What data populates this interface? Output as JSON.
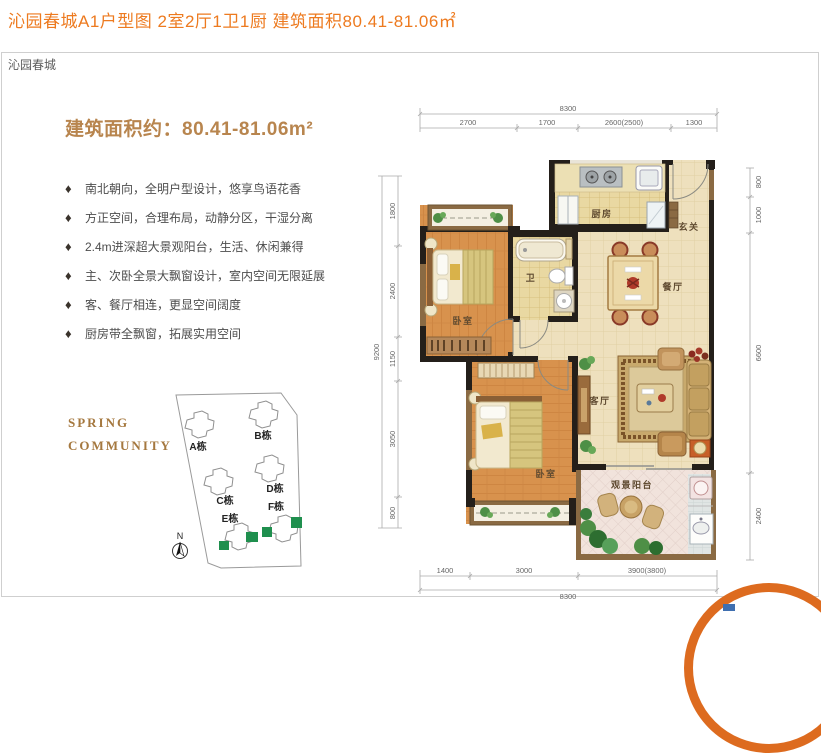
{
  "page": {
    "title": "沁园春城A1户型图 2室2厅1卫1厨  建筑面积80.41-81.06㎡",
    "panel_tab": "沁园春城"
  },
  "info": {
    "area_heading": "建筑面积约：80.41-81.06m²",
    "bullet_icon": "♦",
    "features": [
      "南北朝向，全明户型设计，悠享鸟语花香",
      "方正空间，合理布局，动静分区，干湿分离",
      "2.4m进深超大景观阳台，生活、休闲兼得",
      "主、次卧全景大飘窗设计，室内空间无限延展",
      "客、餐厅相连，更显空间阔度",
      "厨房带全飘窗，拓展实用空间"
    ],
    "brand_line1": "SPRING",
    "brand_line2": "COMMUNITY",
    "north_label": "N"
  },
  "site_map": {
    "buildings": [
      "A栋",
      "B栋",
      "C栋",
      "D栋",
      "E栋",
      "F栋"
    ]
  },
  "floor_plan": {
    "rooms": {
      "bedroom_top": "卧室",
      "bathroom": "卫",
      "kitchen": "厨房",
      "entry": "玄关",
      "dining": "餐厅",
      "living": "客厅",
      "bedroom_bottom": "卧室",
      "balcony": "观景阳台"
    },
    "dims": {
      "top_total": "8300",
      "top_seg_1": "2700",
      "top_seg_2": "1700",
      "top_seg_3": "2600(2500)",
      "top_seg_4": "1300",
      "bottom_seg_1": "1400",
      "bottom_seg_2": "3000",
      "bottom_seg_3": "3900(3800)",
      "bottom_total": "8300",
      "left_total": "9200",
      "left_seg_1": "1800",
      "left_seg_2": "2400",
      "left_seg_3": "1150",
      "left_seg_4": "3050",
      "left_seg_5": "800",
      "right_seg_1": "800",
      "right_seg_2": "1000",
      "right_seg_3": "6600",
      "right_seg_4": "2400"
    }
  },
  "colors": {
    "accent_orange": "#ed7a1f",
    "heading_tan": "#b8854e",
    "brand_brown": "#a5783f",
    "site_green": "#1f8f4e"
  }
}
